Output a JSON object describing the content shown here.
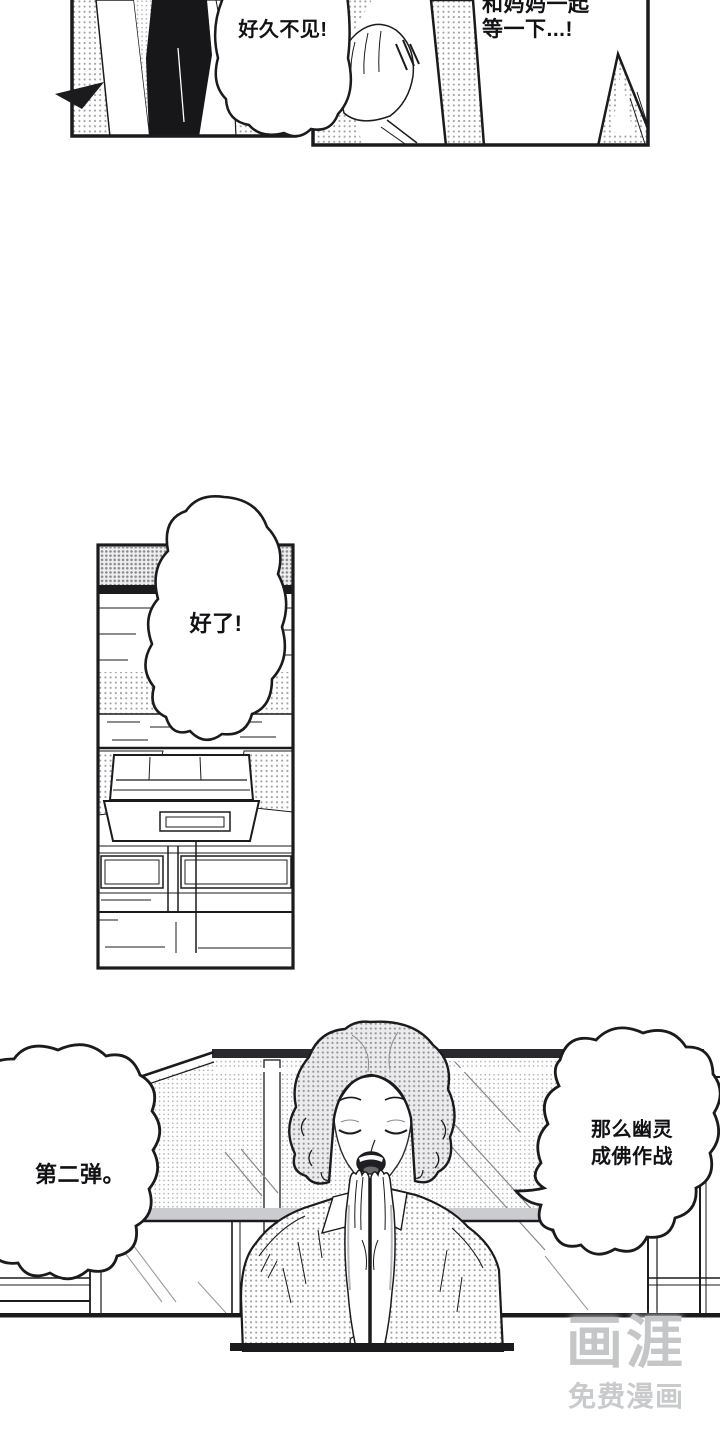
{
  "page": {
    "background": "#ffffff",
    "ink": "#1b1b1e"
  },
  "dialogue": {
    "top_left": "好久不见!",
    "top_right_line1": "和妈妈一起",
    "top_right_line2": "等一下...!",
    "middle": "好了!",
    "bottom_left": "第二弹。",
    "bottom_right_line1": "那么幽灵",
    "bottom_right_line2": "成佛作战"
  },
  "watermark": {
    "logo": "画涯",
    "tagline": "免费漫画",
    "color": "#c6c7c9"
  }
}
